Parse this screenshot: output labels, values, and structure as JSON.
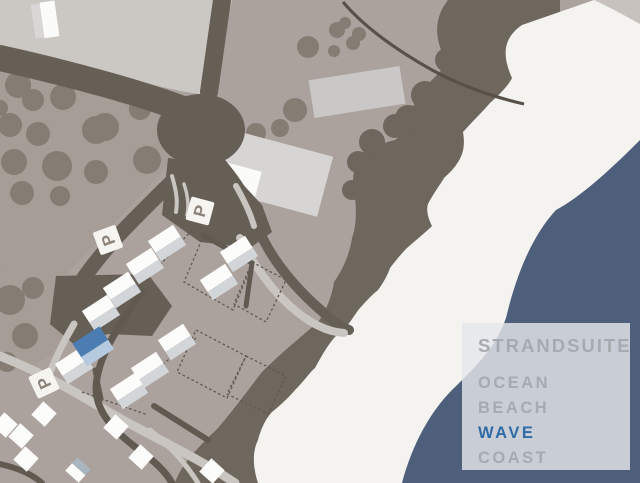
{
  "legend": {
    "title": "STRANDSUITE",
    "title_color": "#a7aaae",
    "items": [
      {
        "label": "OCEAN",
        "active": false,
        "color": "#a7aaae"
      },
      {
        "label": "BEACH",
        "active": false,
        "color": "#a7aaae"
      },
      {
        "label": "WAVE",
        "active": true,
        "color": "#2f6ca6"
      },
      {
        "label": "COAST",
        "active": false,
        "color": "#a7aaae"
      }
    ]
  },
  "parking": {
    "label": "P",
    "count": 3,
    "glyph_color": "#8d8379",
    "sign_color": "#f5f4f1"
  },
  "colors": {
    "sea": "#4e5f7c",
    "beach": "#f4f3f0",
    "field": "#aba29d",
    "orchard": "#a59d96",
    "light_area": "#cbc7c3",
    "dark_vegetation": "#6e675e",
    "road_dark": "#615a51",
    "road_thin": "#57514a",
    "road_light": "#c6c2bd",
    "tree": "#857c74",
    "building_gray": "#c9c8c6",
    "house_roof": "#fcfcfb",
    "house_front": "#d2d6d9",
    "wave_roof": "#4b7db2",
    "wave_front": "#b5c9df",
    "legend_bg": "#e4e7ea"
  }
}
